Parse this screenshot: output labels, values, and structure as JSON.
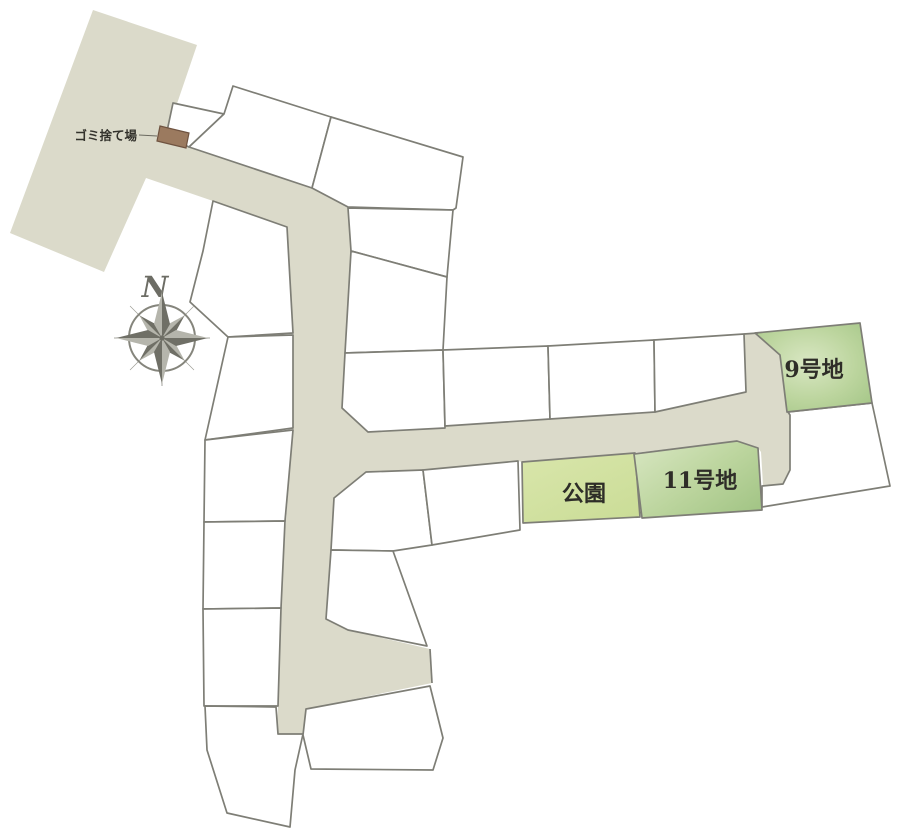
{
  "map": {
    "type": "residential-site-plan",
    "labels": {
      "lot9": "9号地",
      "lot11": "11号地",
      "park": "公園",
      "garbage": "ゴミ捨て場",
      "compass_north": "N"
    },
    "colors": {
      "background": "#ffffff",
      "road": "#dbdaca",
      "lot_fill": "#ffffff",
      "lot_stroke": "#7e7e76",
      "green_edge": "#a3c586",
      "green_mid": "#bcd59e",
      "green_light": "#d9e7c3",
      "park_fill": "#d9e6ab",
      "park_dark": "#cbdd98",
      "garbage_fill": "#9b7a5f",
      "garbage_stroke": "#6f5340",
      "compass": "#85857c",
      "compass_dark": "#6f6f66",
      "compass_light": "#b5b5ac",
      "label_text": "#2e2d28"
    },
    "highlighted_lots": [
      {
        "id": "lot-9",
        "label": "9号地"
      },
      {
        "id": "lot-11",
        "label": "11号地"
      },
      {
        "id": "park",
        "label": "公園"
      }
    ],
    "features": [
      "garbage-station",
      "compass-rose",
      "road-network",
      "unlabeled-lots"
    ]
  }
}
